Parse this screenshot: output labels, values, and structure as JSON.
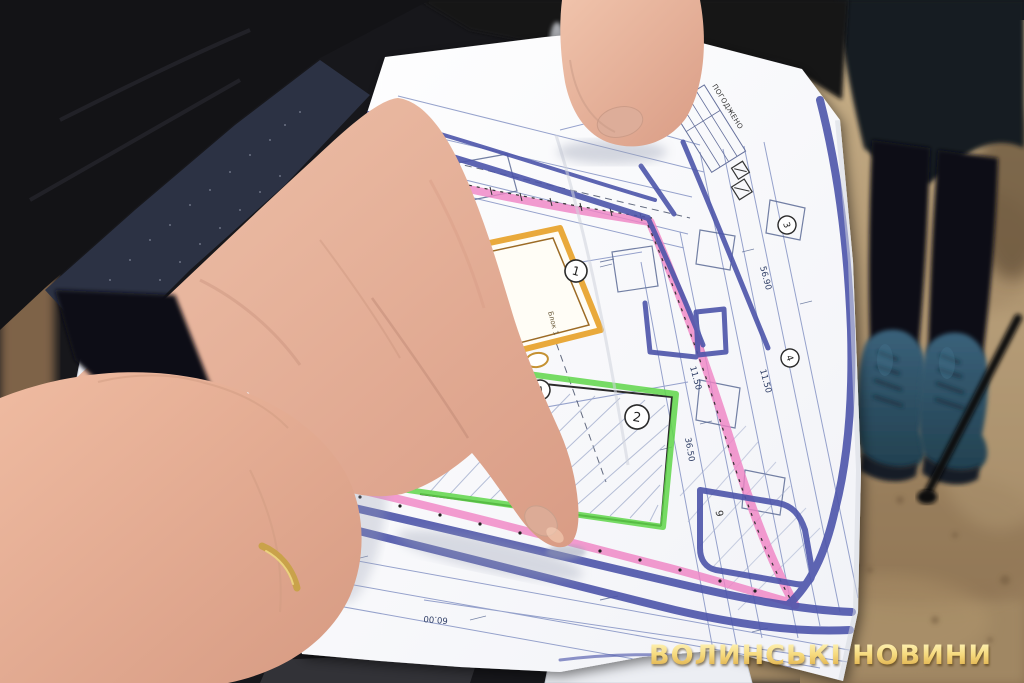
{
  "watermark": {
    "text": "ВОЛИНСЬКІ НОВИНИ",
    "gold": "#e9b94d"
  },
  "plan": {
    "approval_stamp": "ПОГОДЖЕНО",
    "block_label": "Блок 1",
    "marker_labels": {
      "c1": "1",
      "c2": "2",
      "c3": "3",
      "c4": "4",
      "c12": "12",
      "cA": "А",
      "p9": "9"
    },
    "dimensions": {
      "d5690": "56.90",
      "d1150a": "11.50",
      "d1150b": "11.50",
      "d3650": "36.50",
      "d6000": "60.00"
    },
    "colors": {
      "marker_blue": "#4d55aa",
      "highlight_pink": "#f083c4",
      "highlight_green": "#5fd649",
      "building_yellow": "#e9a93b",
      "blueprint_line": "#7d8cc0"
    }
  }
}
